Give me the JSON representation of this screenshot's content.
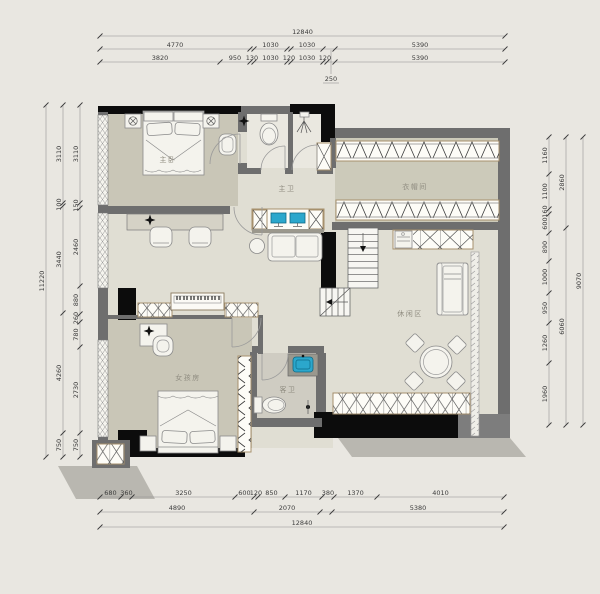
{
  "rooms": {
    "master_bedroom": "主卧",
    "master_bath": "主卫",
    "cloakroom": "衣帽间",
    "leisure": "休闲区",
    "girls_room": "女孩房",
    "guest_bath": "客卫"
  },
  "dims": {
    "extra_250": "250",
    "top": [
      [
        {
          "v": "12840",
          "px": 405
        }
      ],
      [
        {
          "v": "4770",
          "px": 150
        },
        {
          "v": "",
          "px": 4
        },
        {
          "v": "1030",
          "px": 33
        },
        {
          "v": "",
          "px": 4
        },
        {
          "v": "1030",
          "px": 32
        },
        {
          "v": "",
          "px": 12
        },
        {
          "v": "5390",
          "px": 170
        }
      ],
      [
        {
          "v": "3820",
          "px": 120
        },
        {
          "v": "950",
          "px": 30
        },
        {
          "v": "130",
          "px": 4
        },
        {
          "v": "1030",
          "px": 33
        },
        {
          "v": "120",
          "px": 4
        },
        {
          "v": "1030",
          "px": 32
        },
        {
          "v": "120",
          "px": 4
        },
        {
          "v": "",
          "px": 8
        },
        {
          "v": "5390",
          "px": 170
        }
      ]
    ],
    "bottom": [
      [
        {
          "v": "680",
          "px": 21
        },
        {
          "v": "360",
          "px": 11
        },
        {
          "v": "3250",
          "px": 103
        },
        {
          "v": "600",
          "px": 19
        },
        {
          "v": "120",
          "px": 4
        },
        {
          "v": "850",
          "px": 27
        },
        {
          "v": "1170",
          "px": 37
        },
        {
          "v": "380",
          "px": 12
        },
        {
          "v": "1370",
          "px": 43
        },
        {
          "v": "4010",
          "px": 127
        }
      ],
      [
        {
          "v": "4890",
          "px": 154
        },
        {
          "v": "2070",
          "px": 66
        },
        {
          "v": "",
          "px": 12
        },
        {
          "v": "5380",
          "px": 172
        }
      ],
      [
        {
          "v": "12840",
          "px": 404
        }
      ]
    ],
    "left": [
      [
        {
          "v": "11220",
          "px": 352
        }
      ],
      [
        {
          "v": "3110",
          "px": 98
        },
        {
          "v": "100",
          "px": 3
        },
        {
          "v": "3440",
          "px": 107
        },
        {
          "v": "4260",
          "px": 120
        },
        {
          "v": "750",
          "px": 24
        }
      ],
      [
        {
          "v": "3110",
          "px": 98
        },
        {
          "v": "150",
          "px": 5
        },
        {
          "v": "2460",
          "px": 78
        },
        {
          "v": "880",
          "px": 28
        },
        {
          "v": "260",
          "px": 8
        },
        {
          "v": "780",
          "px": 25
        },
        {
          "v": "2730",
          "px": 86
        },
        {
          "v": "750",
          "px": 24
        }
      ]
    ],
    "right": [
      [
        {
          "v": "1160",
          "px": 37
        },
        {
          "v": "1100",
          "px": 35
        },
        {
          "v": "160",
          "px": 5
        },
        {
          "v": "600",
          "px": 19
        },
        {
          "v": "890",
          "px": 28
        },
        {
          "v": "1000",
          "px": 32
        },
        {
          "v": "950",
          "px": 30
        },
        {
          "v": "1260",
          "px": 40
        },
        {
          "v": "1960",
          "px": 62
        }
      ],
      [
        {
          "v": "2860",
          "px": 91
        },
        {
          "v": "6060",
          "px": 197
        }
      ],
      [
        {
          "v": "9070",
          "px": 288
        }
      ]
    ]
  }
}
